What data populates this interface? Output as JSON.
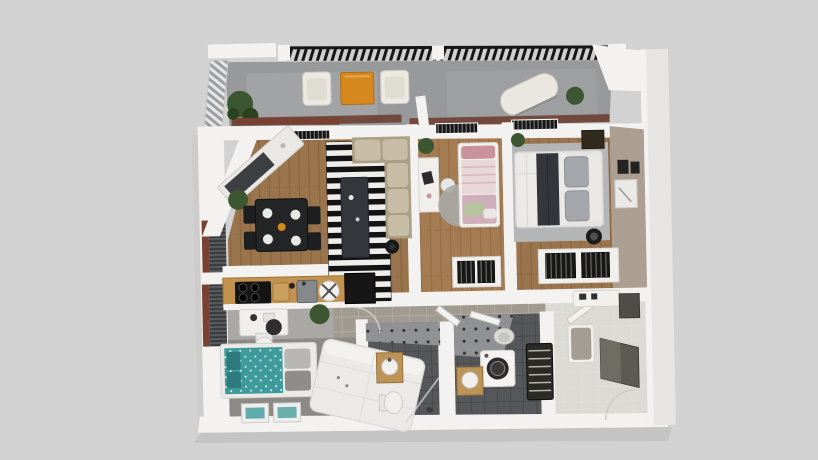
{
  "meta": {
    "description": "Photorealistic top-down 3D floor plan rendering of an apartment",
    "view": "top-down isometric render",
    "canvas": {
      "width": 818,
      "height": 460
    }
  },
  "palette": {
    "bg": "#d2d2d2",
    "buildingShadow": "#c2c2c2",
    "wallWhite": "#f3f2f0",
    "wallShade": "#dddbd7",
    "wallEdge": "#c9c7c3",
    "rightWall": "#e6e5e3",
    "concrete": "#97999a",
    "concreteLight": "#abadad",
    "pergolaDark": "#161616",
    "railLight": "#e6e6e6",
    "railDark": "#9c9ea0",
    "terracotta": "#6e4033",
    "brick": "#774134",
    "blindGray": "#565a5c",
    "woodFloor": "#9a744c",
    "woodLight": "#a57c52",
    "counterWood": "#c2924e",
    "rugBlack": "#131313",
    "rugWhite": "#efeeea",
    "sofaBeige": "#c7bca5",
    "sofaShade": "#ab9f86",
    "tableBlack": "#232527",
    "chairBlack": "#1d1f21",
    "charcoal": "#33363a",
    "pinkDark": "#c9919d",
    "pinkLight": "#e8d7d8",
    "mauve": "#cfb0ba",
    "greenPillow": "#b5c49c",
    "whiteBed": "#eceae7",
    "masterRug": "#b3b5b6",
    "pillowGray": "#a3a6aa",
    "taupe": "#ac9e91",
    "frameDark": "#232323",
    "tileHall": "#a19a90",
    "entryFloor": "#dcdad5",
    "bathFloor": "#55575a",
    "quilt": "#8f9194",
    "tealDuvet": "#3f9a9b",
    "tealDark": "#2e7a7c",
    "officeFloor": "#8b8a86",
    "orange": "#d4881e",
    "plant": "#3c5631",
    "plantDark": "#2c421f",
    "vanityWood": "#bd9458",
    "steel": "#86898b",
    "washerDoor": "#2b2b2b",
    "rackDark": "#2a2a27",
    "mirror": "#5c5b53",
    "clothesDark": "#171715"
  },
  "scene": {
    "rooms": [
      {
        "name": "balcony",
        "floor": "concrete",
        "furniture": [
          "pergola-slats",
          "louvered-railing",
          "lounge-chair",
          "orange-coffee-table",
          "lounge-chair",
          "hammock-lounger",
          "potted-tree",
          "potted-plant"
        ]
      },
      {
        "name": "living-dining-room",
        "floor": "wood-planks",
        "furniture": [
          "diagonal-sideboard",
          "potted-plant",
          "dining-table-black",
          "dining-chairs-x4",
          "striped-rug",
          "dark-coffee-table",
          "beige-corner-sofa",
          "black-side-table",
          "wall-grilles"
        ]
      },
      {
        "name": "kitchen",
        "floor": "tile",
        "furniture": [
          "wood-counter",
          "induction-cooktop",
          "cutting-board",
          "sink",
          "exhaust-fan",
          "black-cabinet",
          "white-vanity",
          "toilet",
          "potted-plant"
        ]
      },
      {
        "name": "pink-bedroom",
        "floor": "wood-planks",
        "furniture": [
          "white-desk",
          "stool",
          "round-gray-rug",
          "pink-single-bed",
          "green-pillow",
          "closet-hanging-clothes",
          "potted-plant"
        ]
      },
      {
        "name": "master-bedroom",
        "floor": "wood-planks",
        "furniture": [
          "gray-area-rug",
          "double-bed-white",
          "charcoal-runner",
          "gray-pillows",
          "dark-nightstand",
          "floor-lamp",
          "wardrobe-hanging-clothes",
          "picture-frames",
          "taupe-accent-wall",
          "potted-plant"
        ]
      },
      {
        "name": "lower-bedroom",
        "floor": "gray-carpet",
        "furniture": [
          "teal-single-bed",
          "gray-pillows",
          "floor-posters-x2",
          "desk-chair",
          "white-double-bed"
        ]
      },
      {
        "name": "bathroom-1",
        "floor": "dark-tile",
        "furniture": [
          "quilted-wall",
          "wood-vanity-sink",
          "toilet",
          "shower-glass"
        ]
      },
      {
        "name": "bathroom-2",
        "floor": "dark-tile",
        "furniture": [
          "quilted-wall",
          "toilet",
          "washing-machine",
          "wood-vanity-sink",
          "ladder-rack"
        ]
      },
      {
        "name": "hallway",
        "floor": "warm-gray-tile",
        "furniture": [
          "open-door-leaf",
          "open-door-leaf",
          "open-door-leaf",
          "door-swing-arc"
        ]
      },
      {
        "name": "entry-hall",
        "floor": "light-tile",
        "furniture": [
          "bench-with-cushion",
          "wall-mirror",
          "console-shelf",
          "wall-niche",
          "door-swing-arc"
        ]
      }
    ]
  }
}
